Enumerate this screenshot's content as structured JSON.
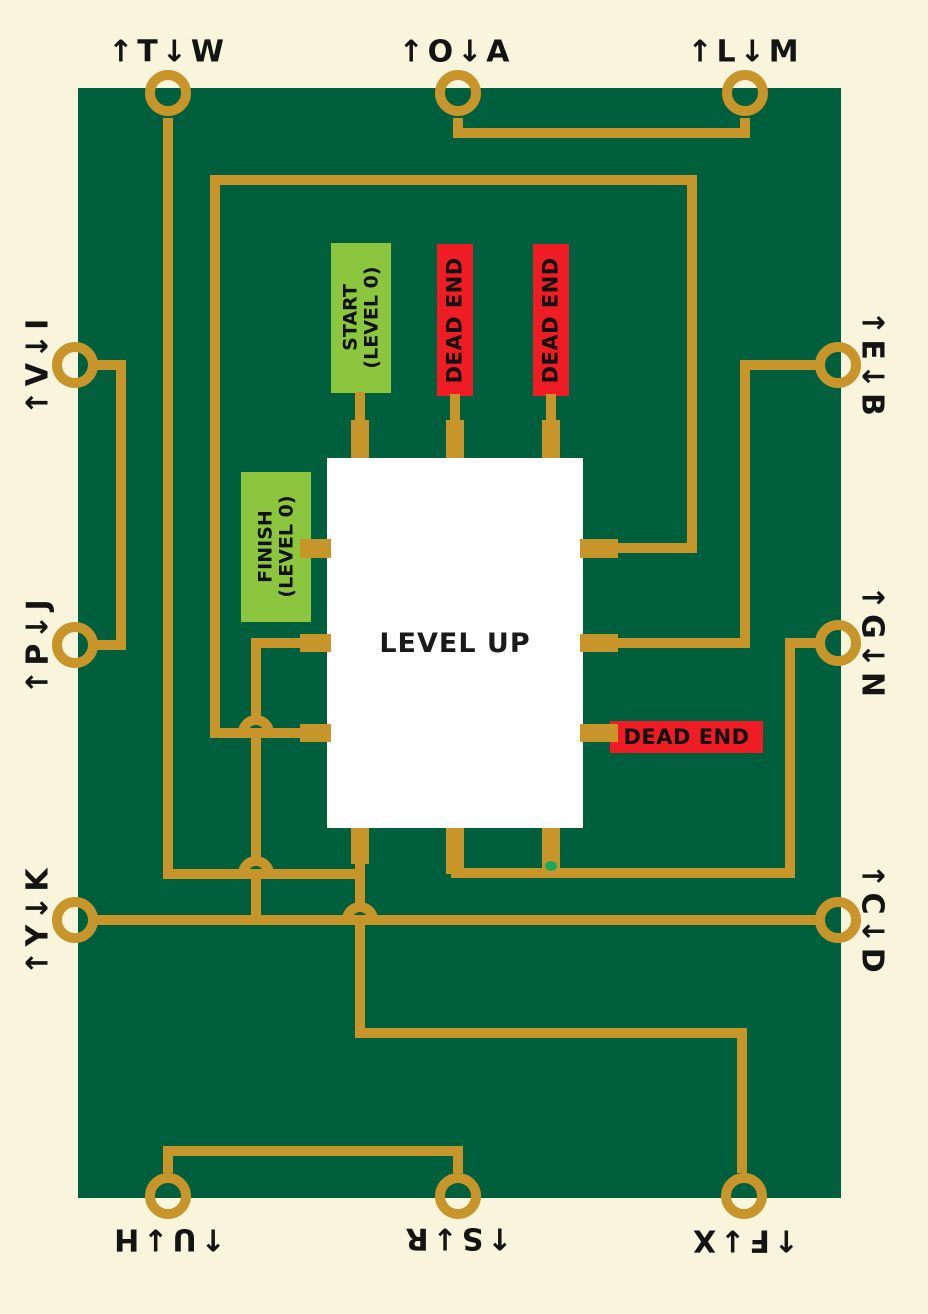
{
  "chip": {
    "title": "LEVEL UP"
  },
  "connectors": {
    "top": [
      {
        "label": "↑T↓W"
      },
      {
        "label": "↑O↓A"
      },
      {
        "label": "↑L↓M"
      }
    ],
    "right": [
      {
        "label": "↑E↓B"
      },
      {
        "label": "↑G↓N"
      },
      {
        "label": "↑C↓D"
      }
    ],
    "bottom": [
      {
        "label": "↑U↓H"
      },
      {
        "label": "↑S↓R"
      },
      {
        "label": "↑F↓X"
      }
    ],
    "left": [
      {
        "label": "↑V↓I"
      },
      {
        "label": "↑P↓J"
      },
      {
        "label": "↑Y↓K"
      }
    ]
  },
  "components": {
    "start": {
      "line1": "START",
      "line2": "(LEVEL 0)"
    },
    "finish": {
      "line1": "FINISH",
      "line2": "(LEVEL 0)"
    },
    "dead_end_1": {
      "label": "DEAD END"
    },
    "dead_end_2": {
      "label": "DEAD END"
    },
    "dead_end_3": {
      "label": "DEAD END"
    }
  },
  "colors": {
    "background": "#F8F5DC",
    "board": "#00603E",
    "trace": "#C8952A",
    "start_finish": "#8CC63E",
    "dead_end": "#F01C24",
    "chip": "#FFFFFF",
    "gap_marker": "#1BA75C",
    "text": "#141414"
  }
}
